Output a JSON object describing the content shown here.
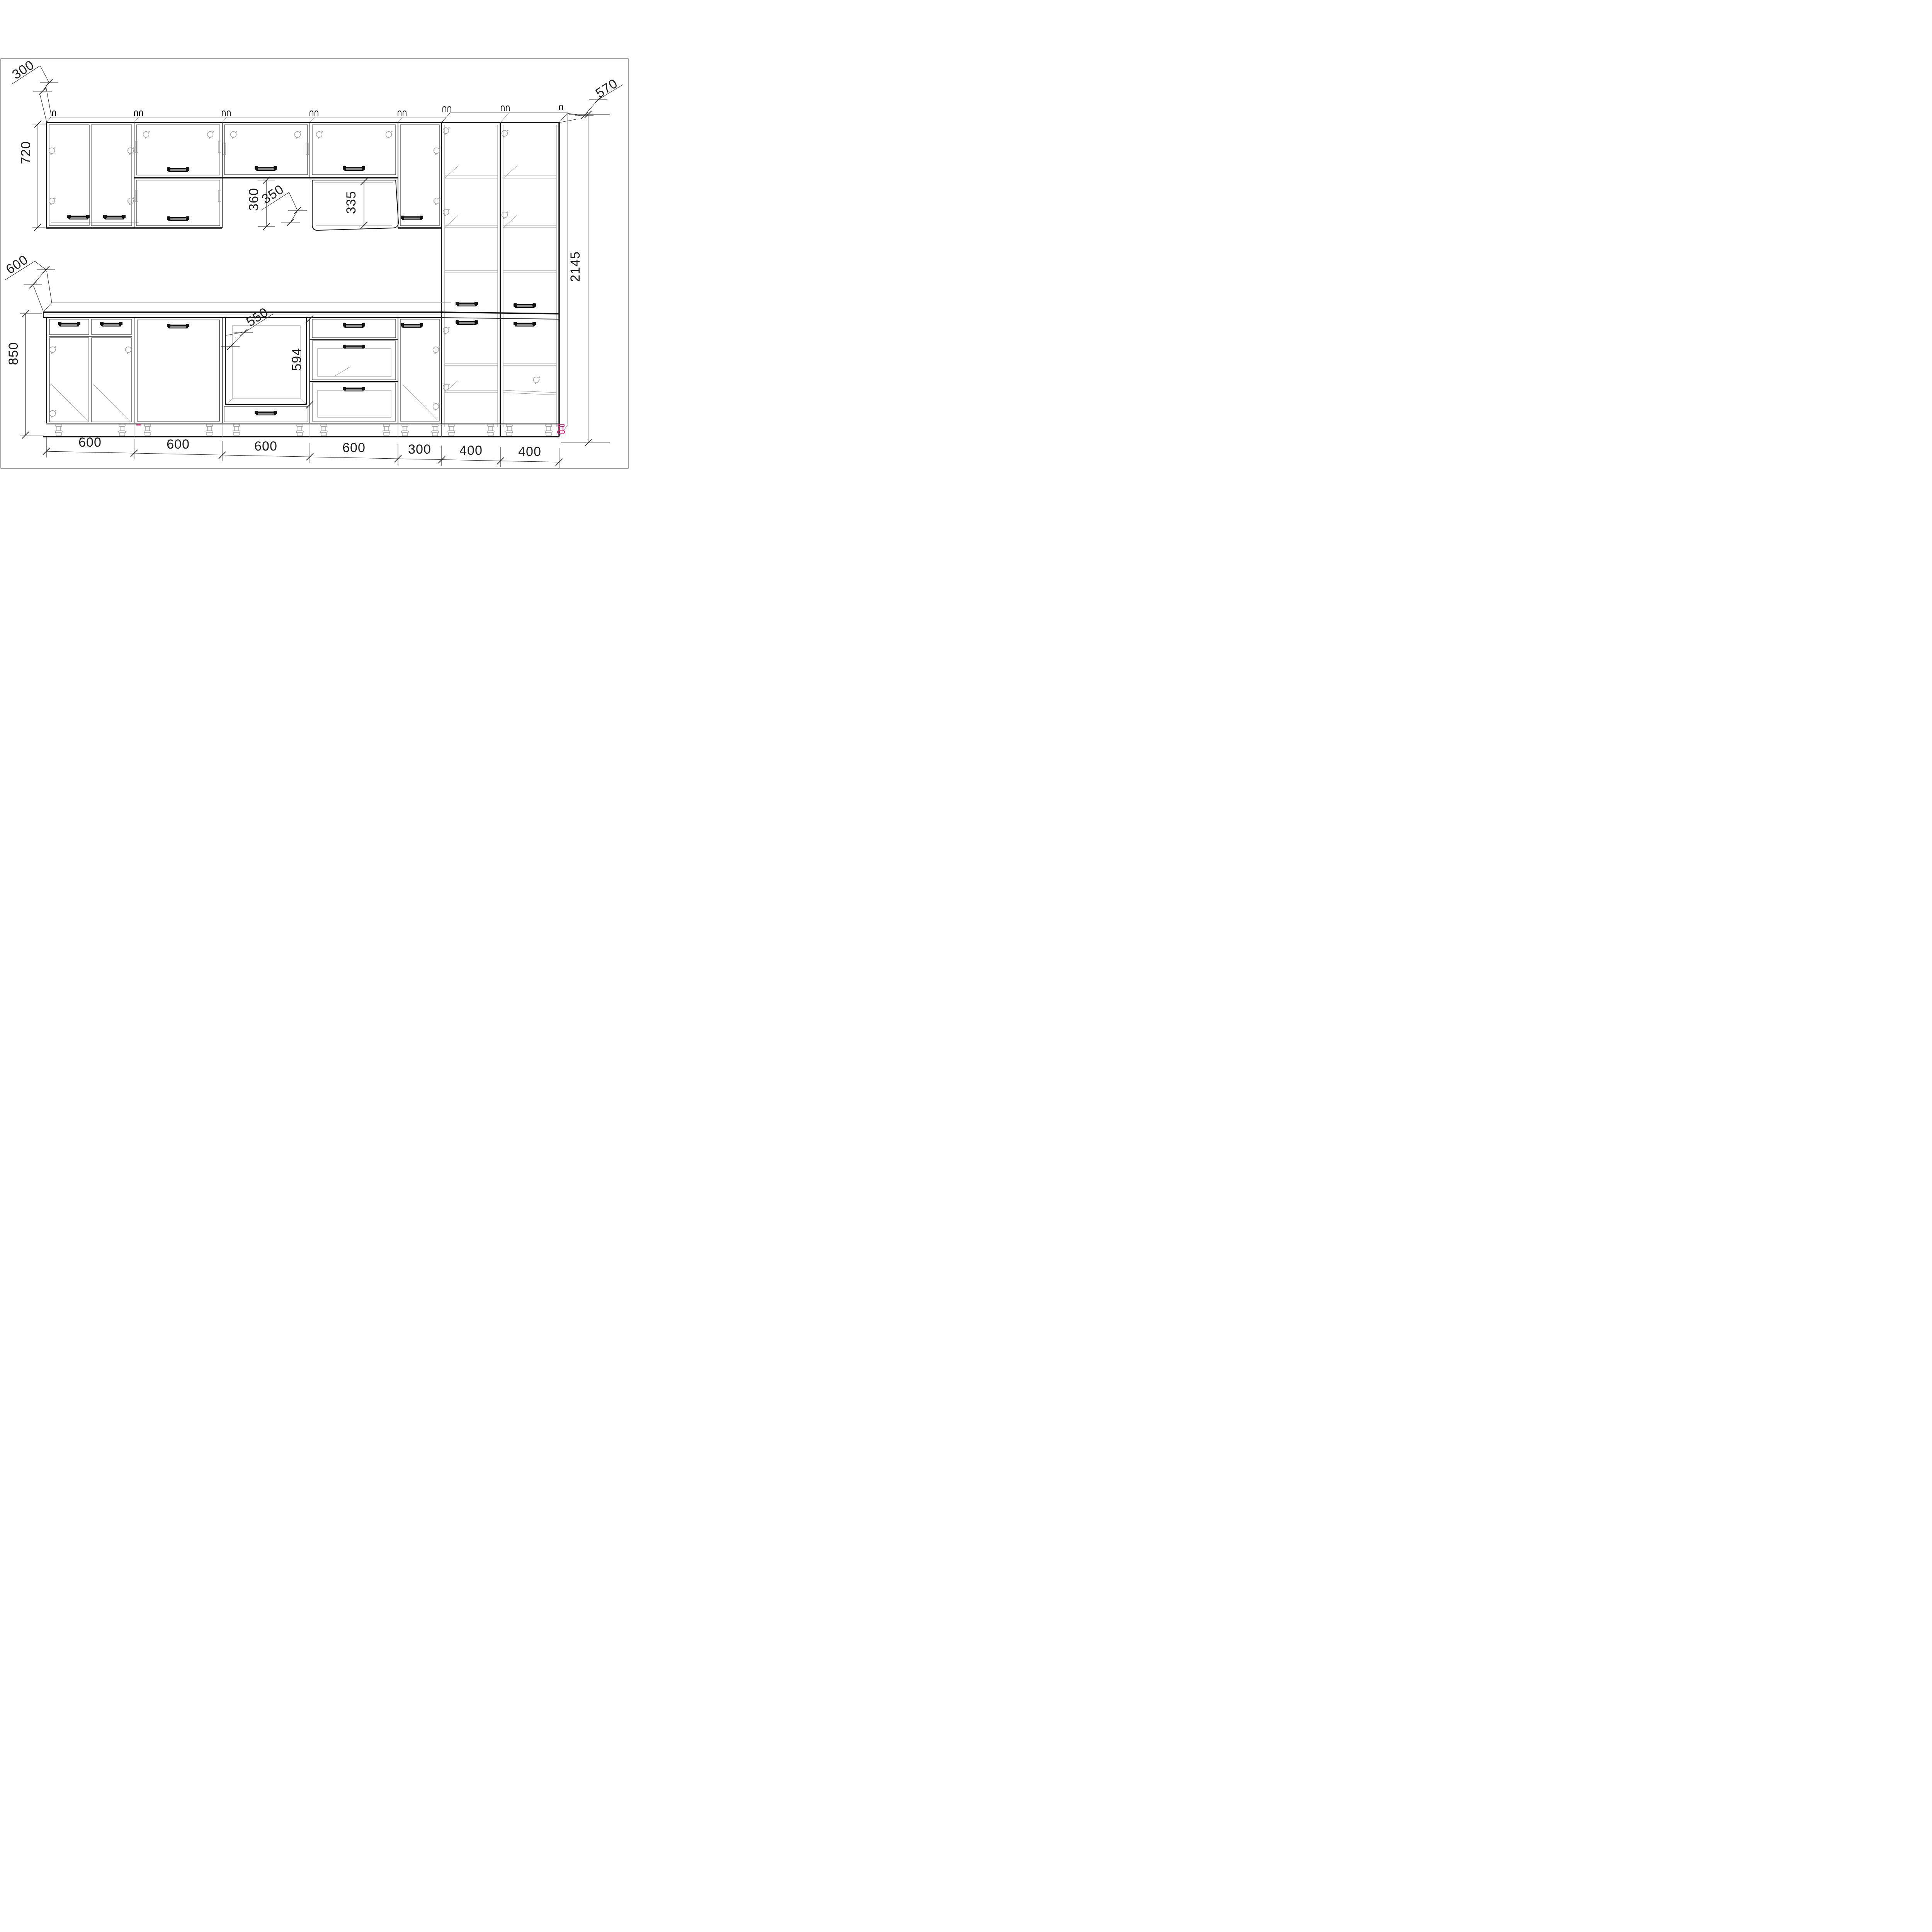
{
  "drawing": {
    "accent_color": "#e8187d",
    "dims": {
      "wall_depth": "300",
      "wall_height": "720",
      "hood_gap": "360",
      "hood_depth": "350",
      "flip_door_height": "335",
      "tall_depth": "570",
      "total_height": "2145",
      "base_depth": "600",
      "base_height": "850",
      "oven_niche_width": "550",
      "oven_niche_height": "594",
      "widths": [
        "600",
        "600",
        "600",
        "600",
        "300",
        "400",
        "400"
      ]
    }
  }
}
